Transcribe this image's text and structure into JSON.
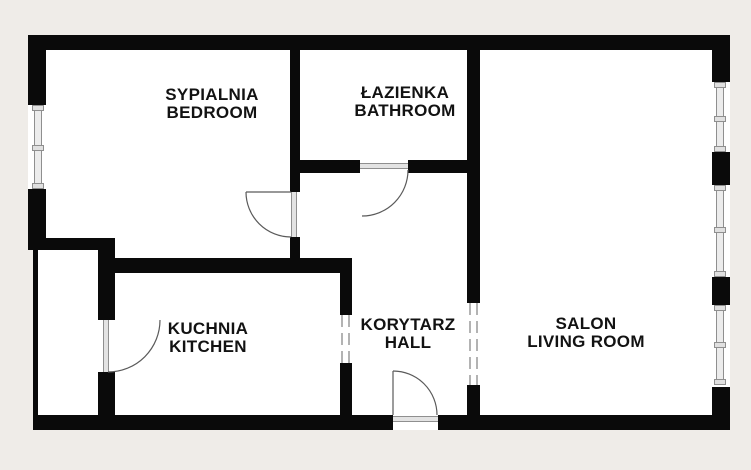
{
  "app": {
    "type": "apartment-floor-plan",
    "background_color": "#efece8",
    "floor_color": "#ffffff",
    "wall_color": "#0a0a0a",
    "detail_line_color": "#8f8f8f"
  },
  "rooms": [
    {
      "id": "bedroom",
      "label_pl": "SYPIALNIA",
      "label_en": "BEDROOM"
    },
    {
      "id": "bathroom",
      "label_pl": "ŁAZIENKA",
      "label_en": "BATHROOM"
    },
    {
      "id": "kitchen",
      "label_pl": "KUCHNIA",
      "label_en": "KITCHEN"
    },
    {
      "id": "hall",
      "label_pl": "KORYTARZ",
      "label_en": "HALL"
    },
    {
      "id": "living_room",
      "label_pl": "SALON",
      "label_en": "LIVING ROOM"
    }
  ]
}
